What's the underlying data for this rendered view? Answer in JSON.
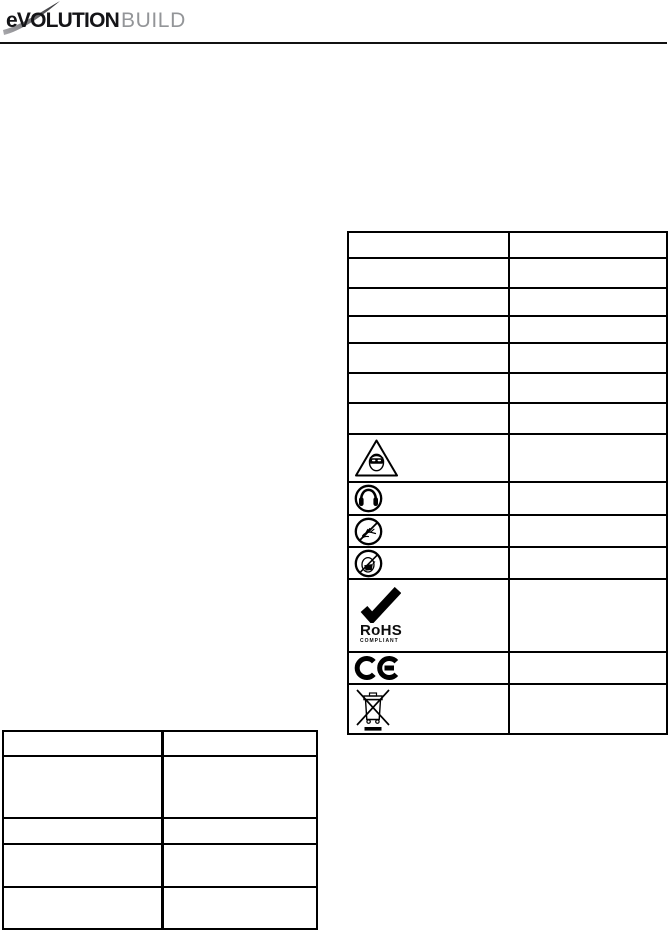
{
  "page": {
    "type": "instruction-manual-page",
    "background": "#ffffff"
  },
  "header": {
    "logo": {
      "primary": "eVOLUTION",
      "secondary": "BUILD",
      "primary_color": "#141417",
      "secondary_color": "#939598",
      "swoosh_icon": "gray curved swoosh stroke over the wordmark"
    },
    "divider_color": "#111111"
  },
  "rohs": {
    "title": "RoHS",
    "subtitle": "COMPLIANT"
  },
  "symbols_table": {
    "columns": [
      "symbol",
      "description"
    ],
    "rows": [
      {
        "symbol": "",
        "description": ""
      },
      {
        "symbol": "",
        "description": ""
      },
      {
        "symbol": "",
        "description": ""
      },
      {
        "symbol": "",
        "description": ""
      },
      {
        "symbol": "",
        "description": ""
      },
      {
        "symbol": "",
        "description": ""
      },
      {
        "symbol": "",
        "description": ""
      },
      {
        "symbol": "wear-eye-protection-icon",
        "description": ""
      },
      {
        "symbol": "wear-ear-protection-icon",
        "description": ""
      },
      {
        "symbol": "do-not-touch-icon",
        "description": ""
      },
      {
        "symbol": "dust-mask-warning-icon",
        "description": ""
      },
      {
        "symbol": "rohs-compliant-icon",
        "description": ""
      },
      {
        "symbol": "ce-mark-icon",
        "description": ""
      },
      {
        "symbol": "weee-crossed-bin-icon",
        "description": ""
      }
    ]
  },
  "spec_table": {
    "columns": 2,
    "rows": 5,
    "cells": "empty"
  },
  "icons": {
    "wear-eye-protection-icon": "triangle with face wearing safety goggles",
    "wear-ear-protection-icon": "circle with ear defenders",
    "do-not-touch-icon": "circle with hands and prohibition slash",
    "dust-mask-warning-icon": "circle with masked face and prohibition slash",
    "rohs-compliant-icon": "bold black checkmark with RoHS COMPLIANT text",
    "ce-mark-icon": "CE conformity mark",
    "weee-crossed-bin-icon": "crossed-out wheelie bin with solid bar"
  }
}
